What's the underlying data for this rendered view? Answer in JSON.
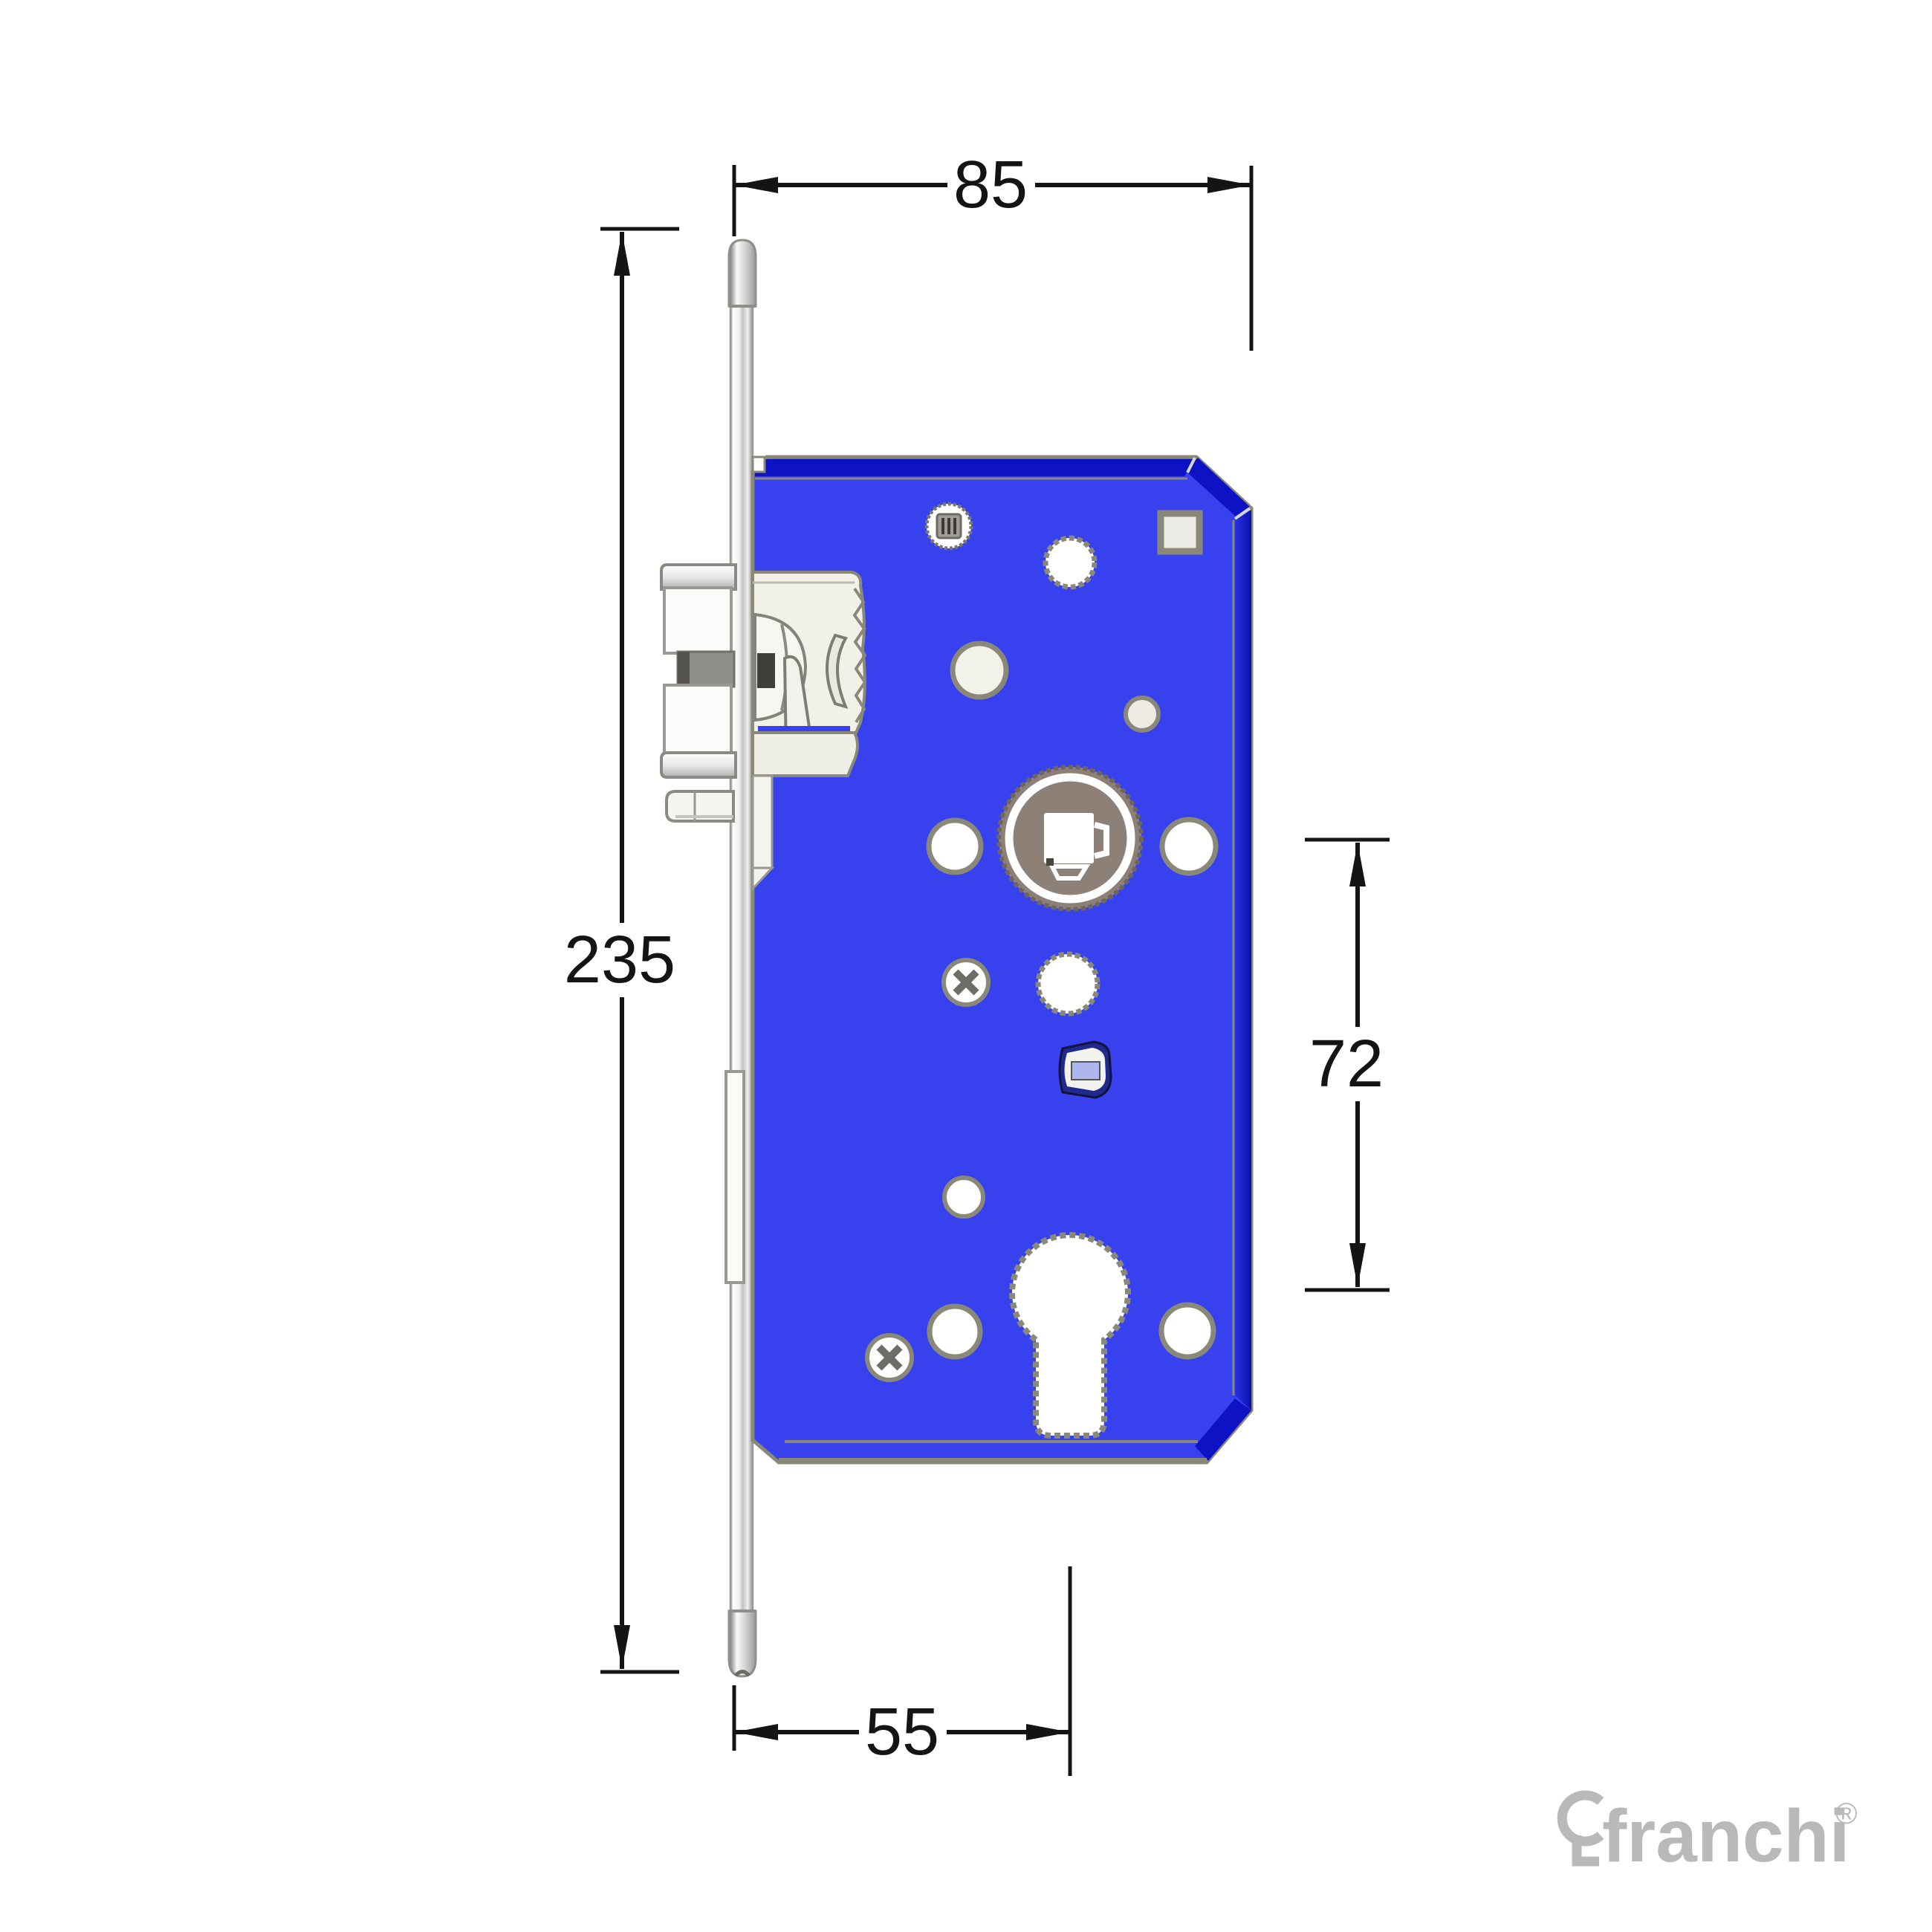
{
  "page": {
    "background_color": "#ffffff"
  },
  "drawing": {
    "subject": "mortise-lock-case-side-view-technical-drawing",
    "dimensions": {
      "case_depth": {
        "label": "85",
        "orientation": "horizontal",
        "position": "top"
      },
      "faceplate_length": {
        "label": "235",
        "orientation": "vertical",
        "position": "left"
      },
      "centre_distance": {
        "label": "72",
        "orientation": "vertical",
        "position": "right"
      },
      "backset": {
        "label": "55",
        "orientation": "horizontal",
        "position": "bottom"
      }
    },
    "colors": {
      "plate_blue": "#3742ee",
      "plate_edge_dark": "#0d12c4",
      "plate_edge_side": "#121cce",
      "outline_gray": "#8a8878",
      "follower_taupe": "#8d8076",
      "metal_light": "#f2f2ec",
      "dimension_ink": "#141414"
    }
  },
  "brand": {
    "logo_text": "franchi",
    "registered_mark": "®",
    "color": "#b9b9b9"
  }
}
